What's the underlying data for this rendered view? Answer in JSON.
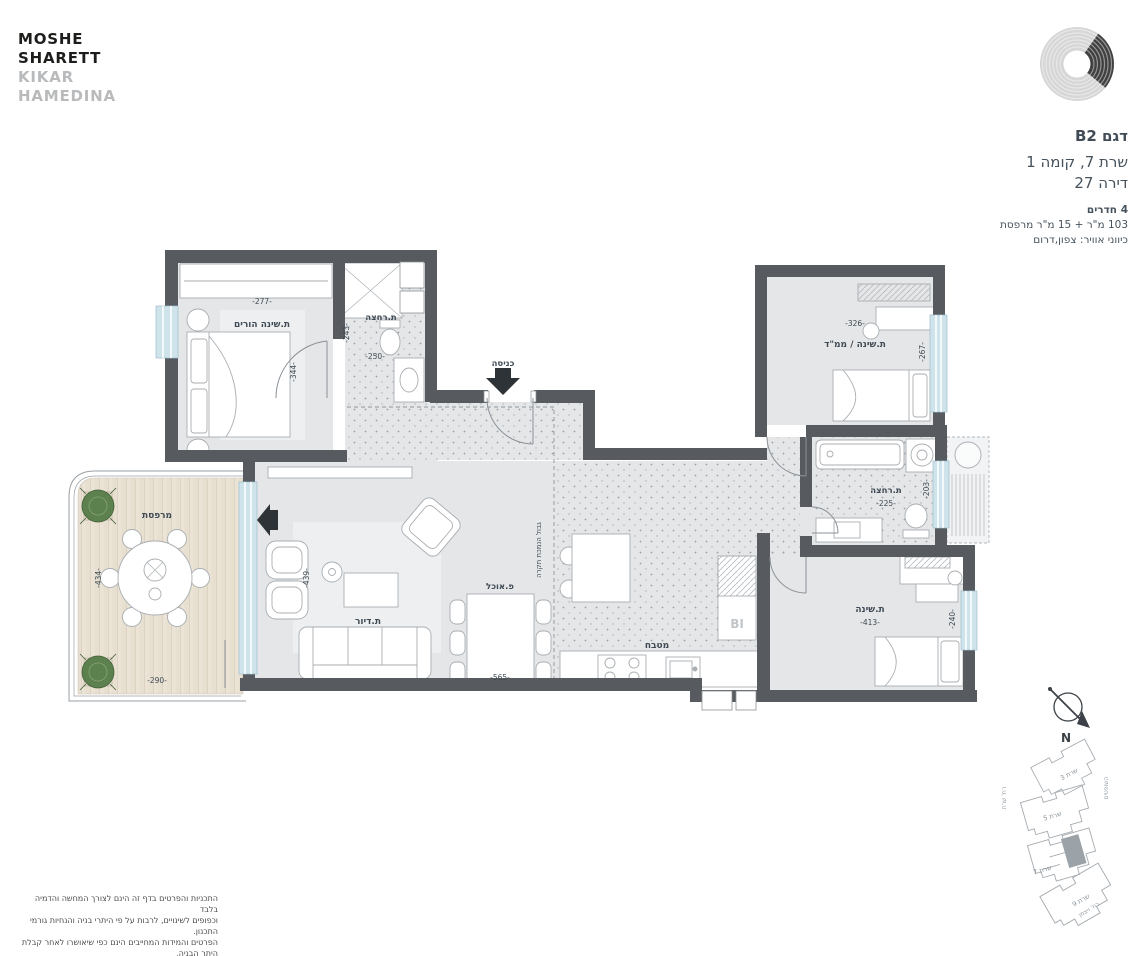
{
  "brand": {
    "line1": "MOSHE",
    "line2": "SHARETT",
    "line3": "KIKAR",
    "line4": "HAMEDINA"
  },
  "unit": {
    "model": "דגם B2",
    "address": "שרת 7, קומה 1",
    "apartment": "דירה 27",
    "rooms": "4 חדרים",
    "area": "103 מ\"ר + 15 מ\"ר מרפסת",
    "air": "כיווני אוויר: צפון,דרום"
  },
  "plan": {
    "entrance": "כניסה",
    "ceiling_boundary": "גבול הנמכת תקרה",
    "bi": "BI",
    "master": {
      "label": "ת.שינה הורים",
      "width": "-277-",
      "height": "-344-"
    },
    "master_bath": {
      "label": "ת.רחצה",
      "width": "-250-",
      "height": "-243-"
    },
    "living": {
      "label": "ת.דיור",
      "height": "-439-"
    },
    "dining": {
      "label": "פ.אוכל",
      "width": "-565-"
    },
    "kitchen": {
      "label": "מטבח"
    },
    "mamad": {
      "label": "ת.שינה / ממ\"ד",
      "width": "-326-",
      "height": "-267-"
    },
    "bath": {
      "label": "ת.רחצה",
      "width": "-225-",
      "height": "-203-"
    },
    "bedroom": {
      "label": "ת.שינה",
      "width": "-413-",
      "height": "-240-"
    },
    "balcony": {
      "label": "מרפסת",
      "width": "-290-",
      "height": "-434-"
    }
  },
  "site": {
    "north": "N",
    "buildings": [
      {
        "label": "שרת 3"
      },
      {
        "label": "שרת 5"
      },
      {
        "label": "שרת 7"
      },
      {
        "label": "שרת 9"
      }
    ],
    "streets": {
      "left": "רח' שרת",
      "right": "השופטים",
      "bottom": "רח' ויצמן"
    }
  },
  "disclaimer": {
    "lines": [
      "התכניות והפרטים בדף זה הינם לצורך המחשה והדמיה בלבד",
      "וכפופים לשינויים, לרבות על פי היתרי בניה והנחיות גורמי התכנון.",
      "הפרטים והמידות המחייבים הינם כפי שיאושרו לאחר קבלת היתר הבניה,",
      "והם בלבד יחייבו את החברה."
    ]
  },
  "colors": {
    "wall": "#575b5f",
    "floor": "#e4e6e7",
    "wood": "#ebe3d5",
    "window": "#cfe3eb",
    "text": "#3f4a55",
    "logo_gray": "#b9babc",
    "logo_black": "#1d1d1b"
  }
}
